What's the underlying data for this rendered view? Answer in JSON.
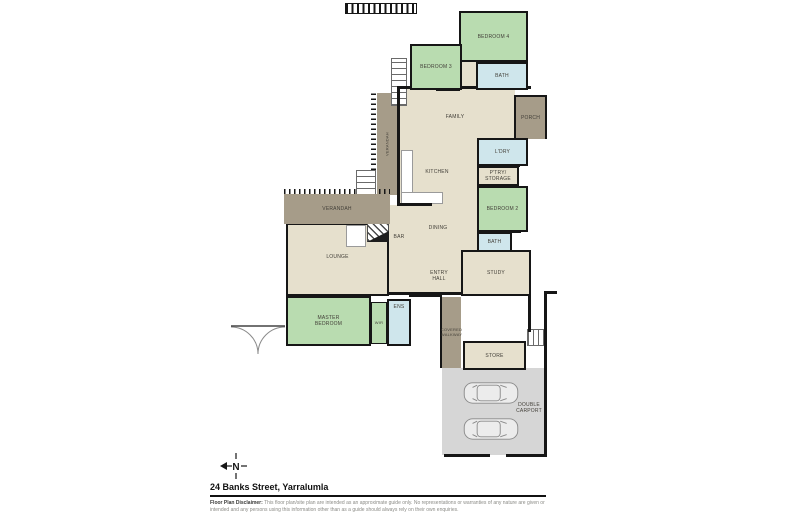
{
  "plan": {
    "rooms": {
      "bedroom4": "BEDROOM 4",
      "bedroom3": "BEDROOM 3",
      "bath_upper": "BATH",
      "family": "FAMILY",
      "porch": "PORCH",
      "verandah_side": "VERANDAH",
      "kitchen": "KITCHEN",
      "laundry": "L'DRY",
      "pantry": "P'TRY/\nSTORAGE",
      "bedroom2": "BEDROOM 2",
      "bath_lower": "BATH",
      "study": "STUDY",
      "dining": "DINING",
      "bar": "BAR",
      "lounge": "LOUNGE",
      "verandah_front": "VERANDAH",
      "entry_hall": "ENTRY\nHALL",
      "master_bedroom": "MASTER\nBEDROOM",
      "wir": "WIR",
      "ensuite": "ENS",
      "covered_walkway": "COVERED\nWALKWAY",
      "store": "STORE",
      "double_carport": "DOUBLE\nCARPORT"
    },
    "small_labels": {
      "robe": "ROBE",
      "wc": "WC",
      "cupd": "CUPD"
    },
    "compass": {
      "north": "N"
    }
  },
  "footer": {
    "title": "24 Banks Street, Yarralumla",
    "disclaimer_label": "Floor Plan Disclaimer:",
    "disclaimer_text": "This floor plan/site plan are intended as an approximate guide only. No representations or warranties of any nature are given or intended and any persons using this information other than as a guide should always rely on their own enquiries."
  },
  "colors": {
    "bedroom_green": "#b9dcb0",
    "wet_area_blue": "#cfe6ec",
    "living_beige": "#e6e0cd",
    "outdoor_taupe": "#a69c89",
    "carport_grey": "#d6d6d6",
    "wall_black": "#161616"
  }
}
